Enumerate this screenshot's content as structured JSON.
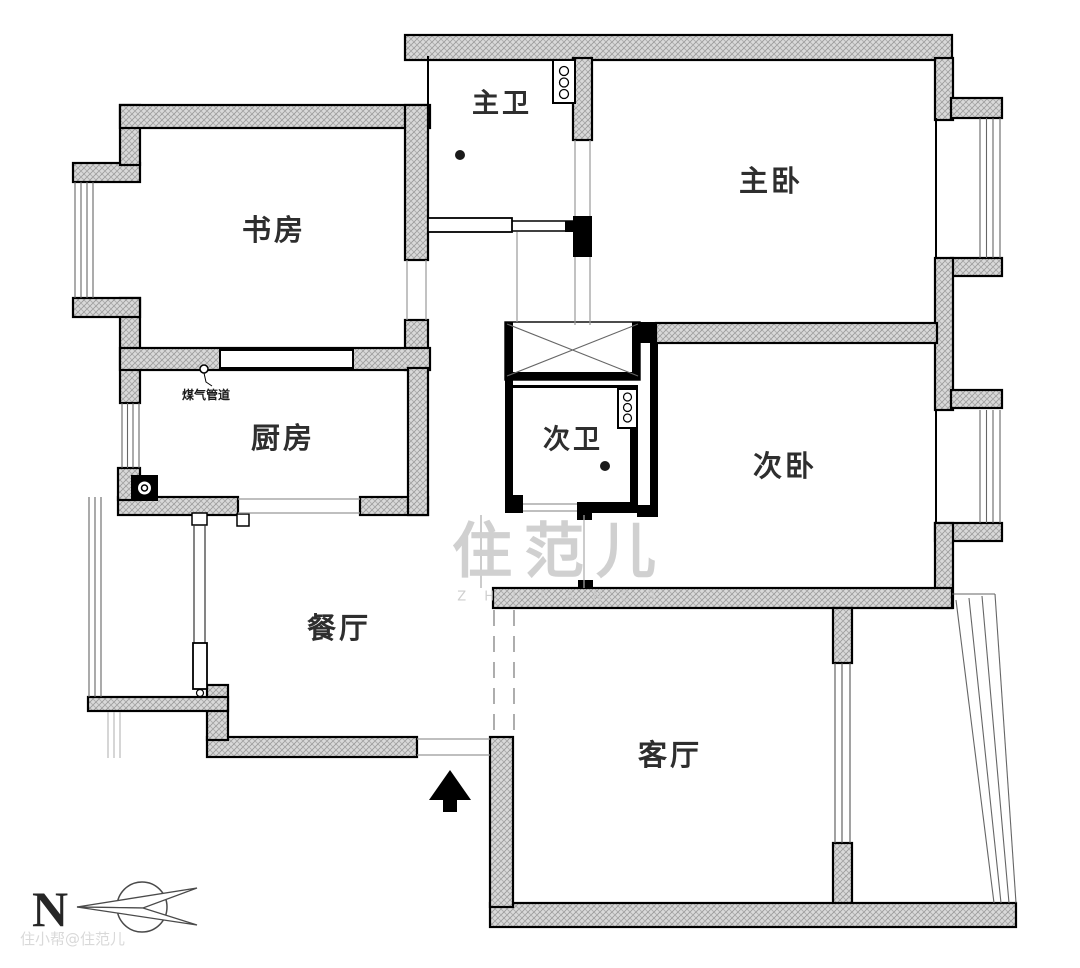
{
  "document": {
    "type": "apartment-floor-plan"
  },
  "rooms": [
    {
      "id": "master-bath",
      "label": "主卫"
    },
    {
      "id": "master-bedroom",
      "label": "主卧"
    },
    {
      "id": "study",
      "label": "书房"
    },
    {
      "id": "kitchen",
      "label": "厨房"
    },
    {
      "id": "second-bath",
      "label": "次卫"
    },
    {
      "id": "second-bedroom",
      "label": "次卧"
    },
    {
      "id": "dining-room",
      "label": "餐厅"
    },
    {
      "id": "living-room",
      "label": "客厅"
    }
  ],
  "annotations": {
    "gas_pipe": "煤气管道",
    "compass_north": "N",
    "watermark_center": "住范儿",
    "watermark_letters": "Z H U F A N E R",
    "watermark_corner": "住小帮@住范儿"
  },
  "colors": {
    "background": "#ffffff",
    "wall_hatch_fill": "#d9d9d9",
    "wall_hatch_line": "#9a9a9a",
    "wall_outline": "#000000",
    "label_text": "#2e2e2e",
    "watermark": "#d0d0d0",
    "thin_line": "#999999"
  }
}
